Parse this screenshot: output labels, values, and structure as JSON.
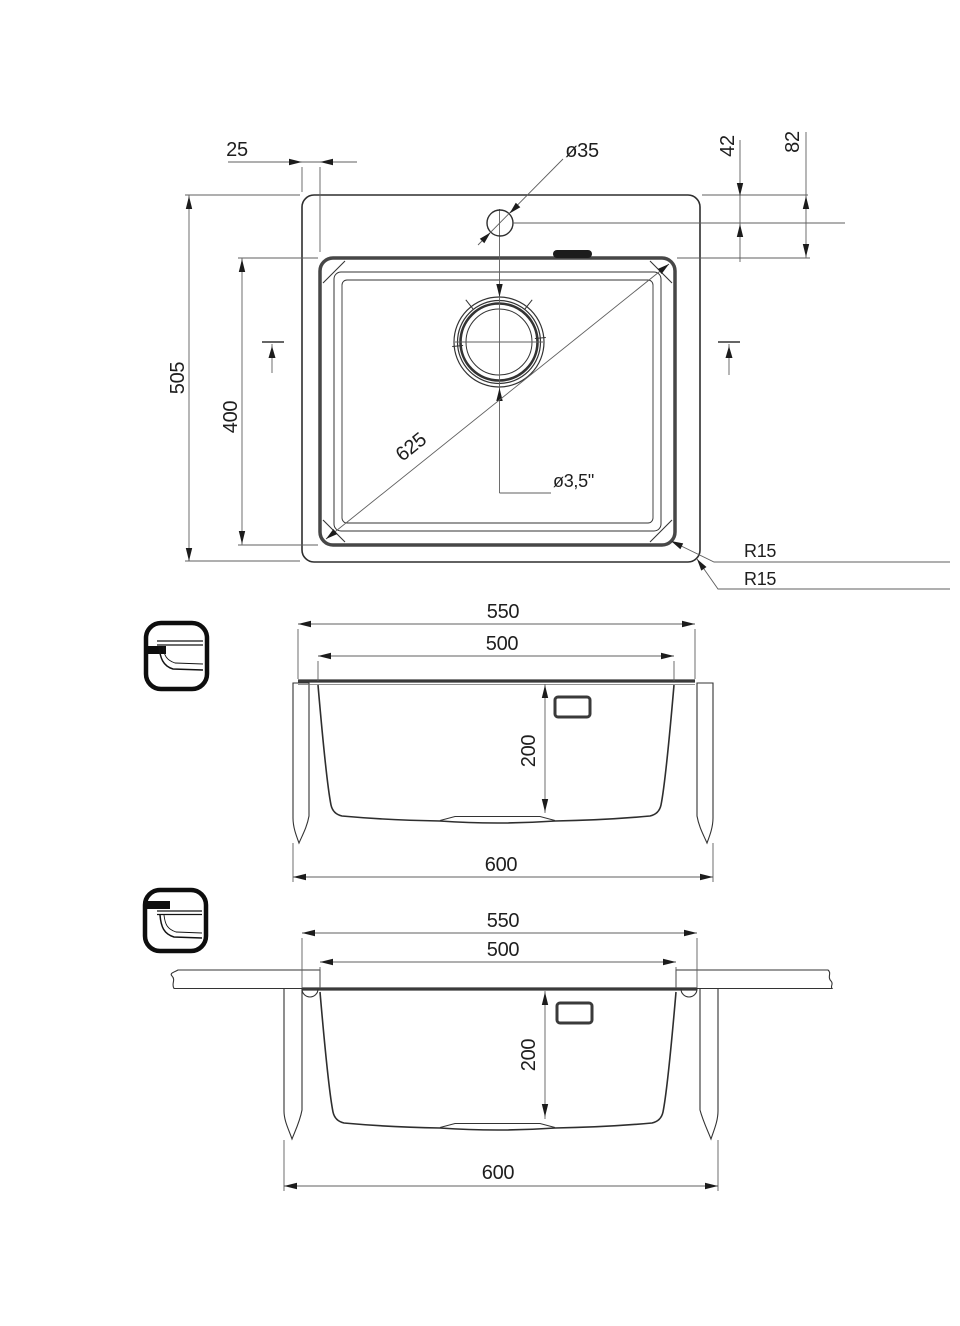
{
  "colors": {
    "background": "#ffffff",
    "ink": "#1e1e1e",
    "outline": "#2e2e2e",
    "dimension_line": "#5f5f5f"
  },
  "plan_view": {
    "dim_rim_to_bowl": "25",
    "dim_faucet_hole_diameter": "ø35",
    "dim_faucet_hole_offset": "42",
    "dim_edge_to_bowl": "82",
    "dim_overall_front_to_back": "505",
    "dim_bowl_front_to_back": "400",
    "dim_bowl_diagonal": "625",
    "dim_drain_diameter": "ø3,5\"",
    "dim_bowl_corner_radius": "R15",
    "dim_outer_corner_radius": "R15"
  },
  "sections": {
    "flush_mount": {
      "width_rim": "550",
      "width_bowl": "500",
      "depth": "200",
      "width_overall": "600",
      "icon": "flush-inset-mount"
    },
    "undermount": {
      "width_rim": "550",
      "width_bowl": "500",
      "depth": "200",
      "width_overall": "600",
      "icon": "undermount"
    }
  }
}
